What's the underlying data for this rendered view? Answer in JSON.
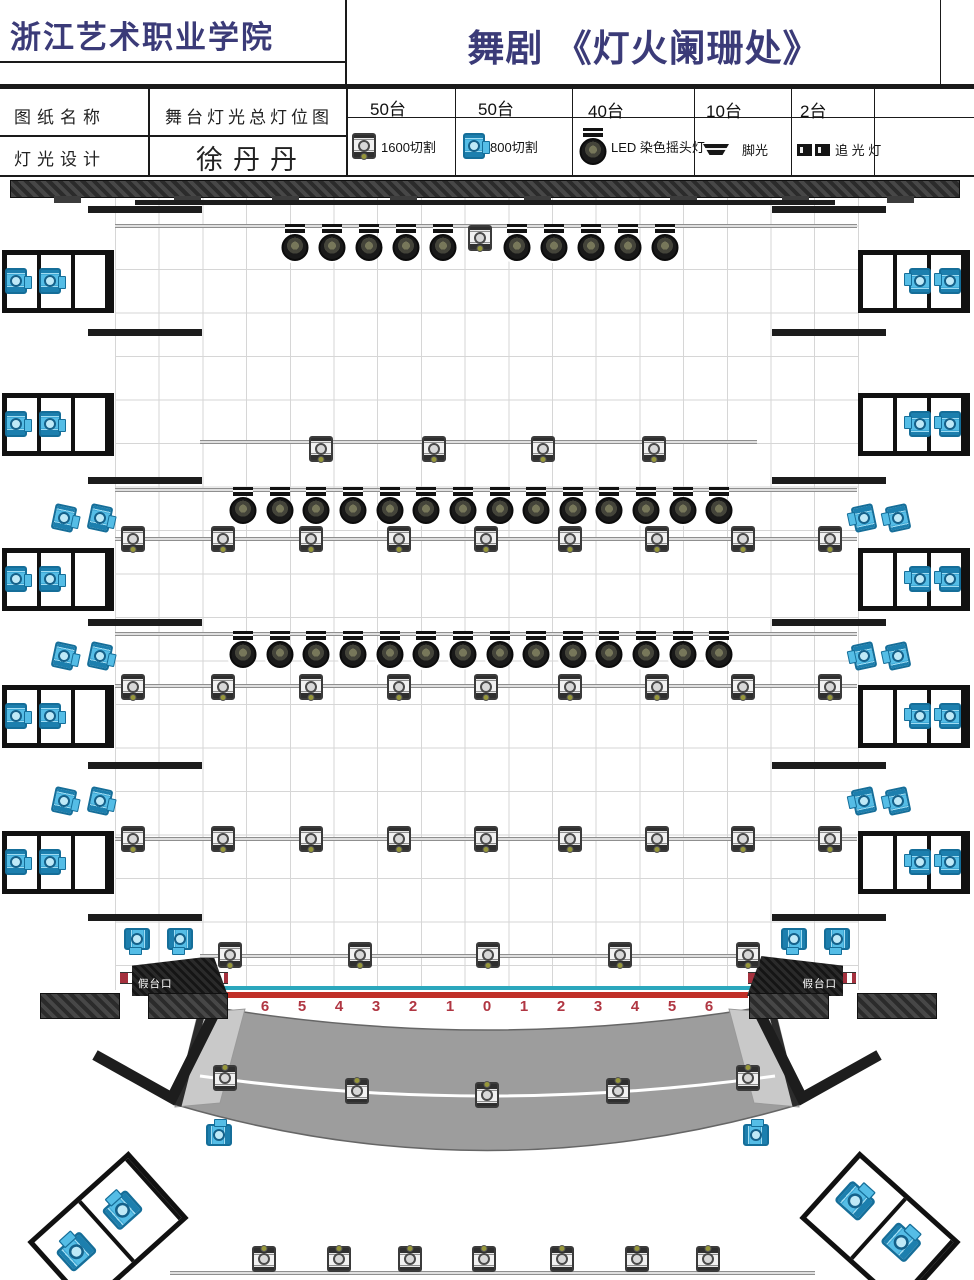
{
  "header": {
    "org": "浙江艺术职业学院",
    "title": "舞剧 《灯火阑珊处》"
  },
  "info_table": {
    "row1_label": "图纸名称",
    "row1_value": "舞台灯光总灯位图",
    "row2_label": "灯光设计",
    "row2_value": "徐丹丹"
  },
  "legend": {
    "columns": [
      {
        "count": "50台",
        "icon": "profile-1600-icon",
        "label": "1600切割"
      },
      {
        "count": "50台",
        "icon": "profile-800-icon",
        "label": "800切割"
      },
      {
        "count": "40台",
        "icon": "moving-head-icon",
        "label": "LED 染色摇头灯"
      },
      {
        "count": "10台",
        "icon": "footlight-icon",
        "label": "脚光"
      },
      {
        "count": "2台",
        "icon": "followspot-icon",
        "label": "追 光 灯"
      }
    ]
  },
  "stage": {
    "false_proscenium_label": "假台口",
    "apron_numbers": [
      "6",
      "5",
      "4",
      "3",
      "2",
      "1",
      "0",
      "1",
      "2",
      "3",
      "4",
      "5",
      "6"
    ]
  },
  "colors": {
    "title_navy": "#3b3b78",
    "fixture_cyan": "#55bde6",
    "number_red": "#b03642",
    "center_line_teal": "#2ba7bd",
    "stage_edge_red": "#c03028",
    "apron_gray": "#9d9d9d"
  },
  "plot": {
    "pipes": [
      {
        "x": 115,
        "y": 224,
        "w": 742
      },
      {
        "x": 200,
        "y": 440,
        "w": 557
      },
      {
        "x": 115,
        "y": 488,
        "w": 742
      },
      {
        "x": 115,
        "y": 537,
        "w": 742
      },
      {
        "x": 115,
        "y": 632,
        "w": 742
      },
      {
        "x": 115,
        "y": 684,
        "w": 742
      },
      {
        "x": 115,
        "y": 837,
        "w": 742
      },
      {
        "x": 200,
        "y": 954,
        "w": 560
      },
      {
        "x": 170,
        "y": 1271,
        "w": 645
      }
    ],
    "fixture_rows": [
      {
        "type": "mh",
        "y": 224,
        "xs": [
          295,
          332,
          369,
          406,
          443,
          517,
          554,
          591,
          628,
          665
        ]
      },
      {
        "type": "prof",
        "y": 225,
        "xs": [
          480
        ]
      },
      {
        "type": "prof",
        "y": 436,
        "xs": [
          321,
          434,
          543,
          654
        ]
      },
      {
        "type": "mh",
        "y": 487,
        "xs": [
          243,
          280,
          316,
          353,
          390,
          426,
          463,
          500,
          536,
          573,
          609,
          646,
          683,
          719
        ]
      },
      {
        "type": "prof",
        "y": 526,
        "xs": [
          133,
          223,
          311,
          399,
          486,
          570,
          657,
          743,
          830
        ]
      },
      {
        "type": "mh",
        "y": 631,
        "xs": [
          243,
          280,
          316,
          353,
          390,
          426,
          463,
          500,
          536,
          573,
          609,
          646,
          683,
          719
        ]
      },
      {
        "type": "prof",
        "y": 674,
        "xs": [
          133,
          223,
          311,
          399,
          486,
          570,
          657,
          743,
          830
        ]
      },
      {
        "type": "prof",
        "y": 826,
        "xs": [
          133,
          223,
          311,
          399,
          486,
          570,
          657,
          743,
          830
        ]
      },
      {
        "type": "prof",
        "y": 942,
        "xs": [
          230,
          360,
          488,
          620,
          748
        ]
      },
      {
        "type": "prof",
        "y": 1246,
        "xs": [
          264,
          339,
          410,
          484,
          562,
          637,
          708
        ],
        "rot": 180
      },
      {
        "type": "prof",
        "xs": [
          225,
          357,
          487,
          618,
          748
        ],
        "ys": [
          1065,
          1078,
          1082,
          1078,
          1065
        ],
        "rot": 180
      },
      {
        "type": "cyan",
        "y": 505,
        "xs": [
          64,
          100
        ],
        "rot": 12
      },
      {
        "type": "cyan",
        "y": 505,
        "xs": [
          864,
          898
        ],
        "rot": 168
      },
      {
        "type": "cyan",
        "y": 643,
        "xs": [
          64,
          100
        ],
        "rot": 12
      },
      {
        "type": "cyan",
        "y": 643,
        "xs": [
          864,
          898
        ],
        "rot": 168
      },
      {
        "type": "cyan",
        "y": 788,
        "xs": [
          64,
          100
        ],
        "rot": 12
      },
      {
        "type": "cyan",
        "y": 788,
        "xs": [
          864,
          898
        ],
        "rot": 168
      },
      {
        "type": "cyan",
        "y": 926,
        "xs": [
          137,
          180
        ],
        "rot": 90
      },
      {
        "type": "cyan",
        "y": 926,
        "xs": [
          794,
          837
        ],
        "rot": 90
      },
      {
        "type": "cyan",
        "y": 1122,
        "xs": [
          219,
          756
        ],
        "rot": -90
      }
    ],
    "towers": {
      "ys": [
        250,
        393,
        548,
        685,
        831
      ],
      "left_x": 2,
      "right_x": 858
    },
    "wing_bars": {
      "ys": [
        206,
        329,
        477,
        619,
        762,
        914
      ],
      "left_x": 88,
      "right_x": 772,
      "w": 114
    },
    "wall": {
      "x": 10,
      "y": 180,
      "w": 948,
      "h": 16,
      "tab_y": 196,
      "tab_xs": [
        54,
        174,
        272,
        390,
        524,
        670,
        782,
        887
      ]
    },
    "border_bar": {
      "x": 135,
      "y": 200,
      "w": 700,
      "h": 5
    },
    "bottom_boxes": [
      {
        "x": 40,
        "y": 1185,
        "rot": -42
      },
      {
        "x": 812,
        "y": 1185,
        "rot": 42
      }
    ],
    "hatch_blocks_x": [
      40,
      148,
      749,
      857
    ],
    "hatch_blocks_y": 993,
    "numbers_x0": 265,
    "numbers_dx": 37,
    "numbers_y": 998
  }
}
